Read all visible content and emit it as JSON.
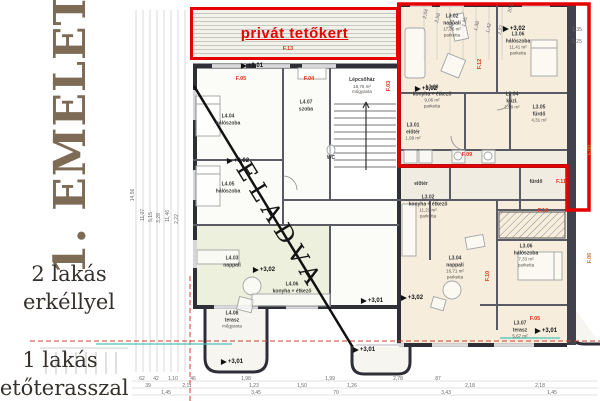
{
  "sidebar": {
    "floor_title": "1. EMELET",
    "note1_line1": "2 lakás",
    "note1_line2": "erkéllyel",
    "note2_line1": "1 lakás",
    "note2_line2": "tetőterasszal"
  },
  "plan": {
    "roof_garden_label": "privát tetőkert",
    "sold_label": "ELADVA",
    "room_labels": [
      {
        "code": "L3.02",
        "name": "nappali",
        "area": "17,86 m²",
        "floor": "parketta",
        "x": 452,
        "y": 26
      },
      {
        "code": "L3.06",
        "name": "hálószoba",
        "area": "11,41 m²",
        "floor": "parketta",
        "x": 518,
        "y": 44
      },
      {
        "code": "L3.03",
        "name": "konyha + étkező",
        "area": "9,06 m²",
        "floor": "parketta",
        "x": 432,
        "y": 97
      },
      {
        "code": "L3.04",
        "name": "közl.",
        "area": "2,98 m²",
        "x": 512,
        "y": 101
      },
      {
        "code": "L3.05",
        "name": "fürdő",
        "area": "4,31 m²",
        "x": 539,
        "y": 114
      },
      {
        "code": "L3.01",
        "name": "előtér",
        "area": "1,99 m²",
        "x": 413,
        "y": 132
      },
      {
        "name": "Lépcsőház",
        "area": "18,76 m²",
        "floor": "műgyanta",
        "x": 362,
        "y": 86
      },
      {
        "code": "L4.04",
        "name": "hálószoba",
        "x": 228,
        "y": 120
      },
      {
        "code": "L4.07",
        "name": "szoba",
        "x": 306,
        "y": 106
      },
      {
        "name": "WC",
        "x": 331,
        "y": 158
      },
      {
        "code": "L4.05",
        "name": "hálószoba",
        "x": 228,
        "y": 188
      },
      {
        "code": "L4.03",
        "name": "nappali",
        "x": 232,
        "y": 262
      },
      {
        "code": "L4.06",
        "name": "konyha + étkező",
        "x": 292,
        "y": 288
      },
      {
        "code": "L4.08",
        "name": "terasz",
        "floor": "műgyanta",
        "x": 232,
        "y": 320
      },
      {
        "code": "L3.02",
        "name": "konyha + étkező",
        "area": "11,21 m²",
        "floor": "parketta",
        "x": 428,
        "y": 207
      },
      {
        "name": "előtér",
        "x": 421,
        "y": 184
      },
      {
        "name": "fürdő",
        "x": 536,
        "y": 182
      },
      {
        "code": "L3.04",
        "name": "nappali",
        "area": "16,71 m²",
        "floor": "parketta",
        "x": 455,
        "y": 268
      },
      {
        "code": "L3.06",
        "name": "hálószoba",
        "area": "7,33 m²",
        "floor": "parketta",
        "x": 526,
        "y": 256
      },
      {
        "code": "L3.07",
        "name": "terasz",
        "area": "5,67 m²",
        "x": 520,
        "y": 330
      }
    ],
    "ref_labels": [
      {
        "text": "F.13",
        "x": 288,
        "y": 49
      },
      {
        "text": "F.05",
        "x": 241,
        "y": 79
      },
      {
        "text": "F.04",
        "x": 309,
        "y": 79
      },
      {
        "text": "F.03",
        "x": 389,
        "y": 86,
        "rot": -90
      },
      {
        "text": "F.12",
        "x": 480,
        "y": 64,
        "rot": -90
      },
      {
        "text": "F.09",
        "x": 467,
        "y": 155
      },
      {
        "text": "F.11",
        "x": 561,
        "y": 182
      },
      {
        "text": "F.16",
        "x": 543,
        "y": 211
      },
      {
        "text": "F.10",
        "x": 488,
        "y": 276,
        "rot": -90
      },
      {
        "text": "F.08",
        "x": 590,
        "y": 150,
        "rot": -90,
        "cls": "orange"
      },
      {
        "text": "F.06",
        "x": 590,
        "y": 258,
        "rot": -90,
        "cls": "orange"
      },
      {
        "text": "F.05",
        "x": 535,
        "y": 319
      }
    ],
    "level_markers": [
      {
        "text": "+3,01",
        "x": 252,
        "y": 66
      },
      {
        "text": "+3,02",
        "x": 514,
        "y": 29
      },
      {
        "text": "+3,02",
        "x": 426,
        "y": 89
      },
      {
        "text": "+3,02",
        "x": 238,
        "y": 161
      },
      {
        "text": "+3,02",
        "x": 264,
        "y": 270
      },
      {
        "text": "+3,02",
        "x": 412,
        "y": 298
      },
      {
        "text": "+3,01",
        "x": 372,
        "y": 301
      },
      {
        "text": "+3,01",
        "x": 546,
        "y": 331
      },
      {
        "text": "+3,01",
        "x": 232,
        "y": 362
      },
      {
        "text": "+3,01",
        "x": 364,
        "y": 350
      }
    ],
    "dim_labels": [
      {
        "text": "14,56",
        "x": 133,
        "y": 195,
        "rot": -90
      },
      {
        "text": "11,07",
        "x": 143,
        "y": 215,
        "rot": -90
      },
      {
        "text": "5,15",
        "x": 151,
        "y": 217,
        "rot": -90
      },
      {
        "text": "3,28",
        "x": 159,
        "y": 218,
        "rot": -90
      },
      {
        "text": "11,46",
        "x": 168,
        "y": 216,
        "rot": -90
      },
      {
        "text": "2,22",
        "x": 177,
        "y": 219,
        "rot": -90
      },
      {
        "text": "2,04",
        "x": 426,
        "y": 14,
        "rot": -75
      },
      {
        "text": "2,58",
        "x": 438,
        "y": 18,
        "rot": -75
      },
      {
        "text": "3,71",
        "x": 452,
        "y": 24,
        "rot": -75
      },
      {
        "text": "1,95",
        "x": 465,
        "y": 22,
        "rot": -75
      },
      {
        "text": "1,38",
        "x": 477,
        "y": 26,
        "rot": -75
      },
      {
        "text": "1,42",
        "x": 489,
        "y": 28,
        "rot": -75
      },
      {
        "text": "2,22",
        "x": 501,
        "y": 30,
        "rot": -75
      },
      {
        "text": "20,5",
        "x": 511,
        "y": 8,
        "rot": -75
      },
      {
        "text": "1,35",
        "x": 577,
        "y": 30
      },
      {
        "text": "1,25",
        "x": 577,
        "y": 42
      },
      {
        "text": "62",
        "x": 142,
        "y": 379
      },
      {
        "text": "42",
        "x": 156,
        "y": 379
      },
      {
        "text": "1,10",
        "x": 173,
        "y": 379
      },
      {
        "text": "46",
        "x": 193,
        "y": 379
      },
      {
        "text": "1,98",
        "x": 246,
        "y": 379
      },
      {
        "text": "1,99",
        "x": 330,
        "y": 379
      },
      {
        "text": "2,78",
        "x": 398,
        "y": 379
      },
      {
        "text": "87",
        "x": 438,
        "y": 379
      },
      {
        "text": "39",
        "x": 148,
        "y": 386
      },
      {
        "text": "2,11",
        "x": 187,
        "y": 386
      },
      {
        "text": "1,23",
        "x": 254,
        "y": 386
      },
      {
        "text": "1,50",
        "x": 302,
        "y": 386
      },
      {
        "text": "1,26",
        "x": 352,
        "y": 386
      },
      {
        "text": "2,18",
        "x": 470,
        "y": 386
      },
      {
        "text": "2,18",
        "x": 540,
        "y": 386
      },
      {
        "text": "1,45",
        "x": 166,
        "y": 393
      },
      {
        "text": "3,45",
        "x": 256,
        "y": 393
      },
      {
        "text": "70",
        "x": 336,
        "y": 393
      },
      {
        "text": "3,43",
        "x": 446,
        "y": 393
      },
      {
        "text": "1,45",
        "x": 552,
        "y": 393
      }
    ]
  },
  "colors": {
    "accent_red": "#e60000",
    "label_red": "#e03514",
    "label_orange": "#c9752b",
    "wall": "#2f2f38",
    "room_fill": "#f6eddd",
    "green_fill": "#edf0dc",
    "teal": "#4cc0b8",
    "title_brown": "#7d6b56"
  }
}
